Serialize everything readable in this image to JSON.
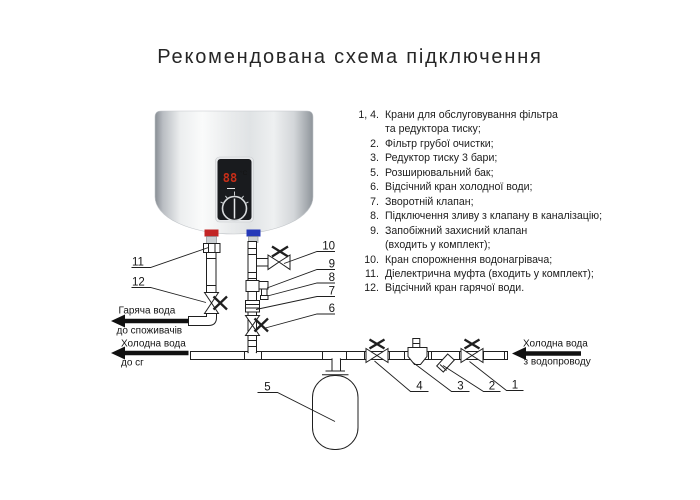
{
  "title": "Рекомендована схема підключення",
  "legend": {
    "rows": [
      {
        "num": "1, 4.",
        "text": "Крани для обслуговування фільтра"
      },
      {
        "num": "",
        "text": "та редуктора тиску;"
      },
      {
        "num": "2.",
        "text": "Фільтр грубої очистки;"
      },
      {
        "num": "3.",
        "text": "Редуктор тиску 3 бари;"
      },
      {
        "num": "5.",
        "text": "Розширювальний бак;"
      },
      {
        "num": "6.",
        "text": "Відсічний кран холодної води;"
      },
      {
        "num": "7.",
        "text": "Зворотній клапан;"
      },
      {
        "num": "8.",
        "text": "Підключення зливу з клапану в каналізацію;"
      },
      {
        "num": "9.",
        "text": "Запобіжний захисний клапан"
      },
      {
        "num": "",
        "text": "(входить у комплект);"
      },
      {
        "num": "10.",
        "text": "Кран спорожнення водонагрівача;"
      },
      {
        "num": "11.",
        "text": "Діелектрична муфта (входить у комплект);"
      },
      {
        "num": "12.",
        "text": "Відсічний кран гарячої води."
      }
    ]
  },
  "diagram": {
    "display": {
      "temp": "88",
      "unit": "°C"
    },
    "labels": {
      "hot_out_1": "Гаряча вода",
      "hot_out_2": "до споживачів",
      "cold_out_1": "Холодна вода",
      "cold_out_2": "до сг",
      "cold_in_1": "Холодна вода",
      "cold_in_2": "з водопроводу"
    },
    "callouts": {
      "c1": "1",
      "c2": "2",
      "c3": "3",
      "c4": "4",
      "c5": "5",
      "c6": "6",
      "c7": "7",
      "c8": "8",
      "c9": "9",
      "c10": "10",
      "c11": "11",
      "c12": "12"
    },
    "colors": {
      "hot_band": "#c22525",
      "cold_band": "#2438b8",
      "display_digits": "#d63018",
      "line": "#1f1f1f"
    }
  }
}
